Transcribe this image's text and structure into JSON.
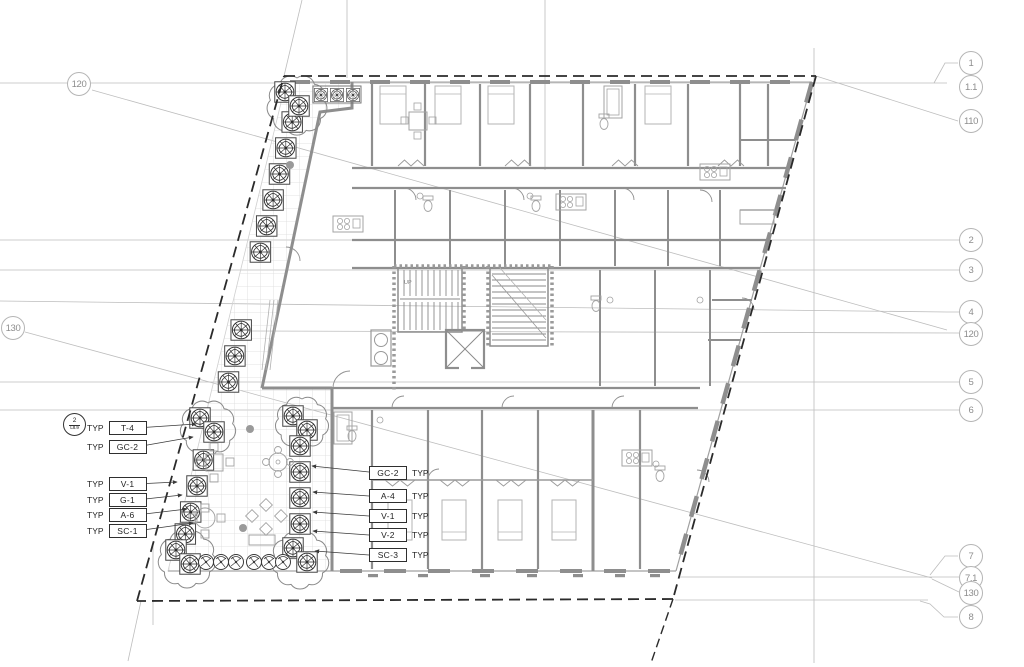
{
  "drawing_labels": {
    "detail_marker": {
      "number": "2",
      "sheet": "L8.9"
    },
    "typ_prefix": "TYP",
    "left_tags": [
      "T-4",
      "GC-2",
      "V-1",
      "G-1",
      "A-6",
      "SC-1"
    ],
    "center_tags": [
      "GC-2",
      "A-4",
      "V-1",
      "V-2",
      "SC-3"
    ],
    "stair_label": "UP",
    "grid_bubbles": {
      "left": [
        "120",
        "130"
      ],
      "right": [
        "1",
        "1.1",
        "110",
        "2",
        "3",
        "4",
        "120",
        "5",
        "6",
        "7",
        "7.1",
        "130",
        "8"
      ]
    }
  },
  "colors": {
    "wall": "#8e8e8e",
    "thin_line": "#bdbdbd",
    "property_line": "#2b2b2b",
    "fixture": "#a3a3a3",
    "tree": "#2f2f2f",
    "cloud_canopy": "#8a8a8a",
    "tile": "#dadada",
    "bubble_stroke": "#b5b5b5",
    "bubble_text": "#8d8d8d",
    "label_text": "#1f1f1f"
  }
}
